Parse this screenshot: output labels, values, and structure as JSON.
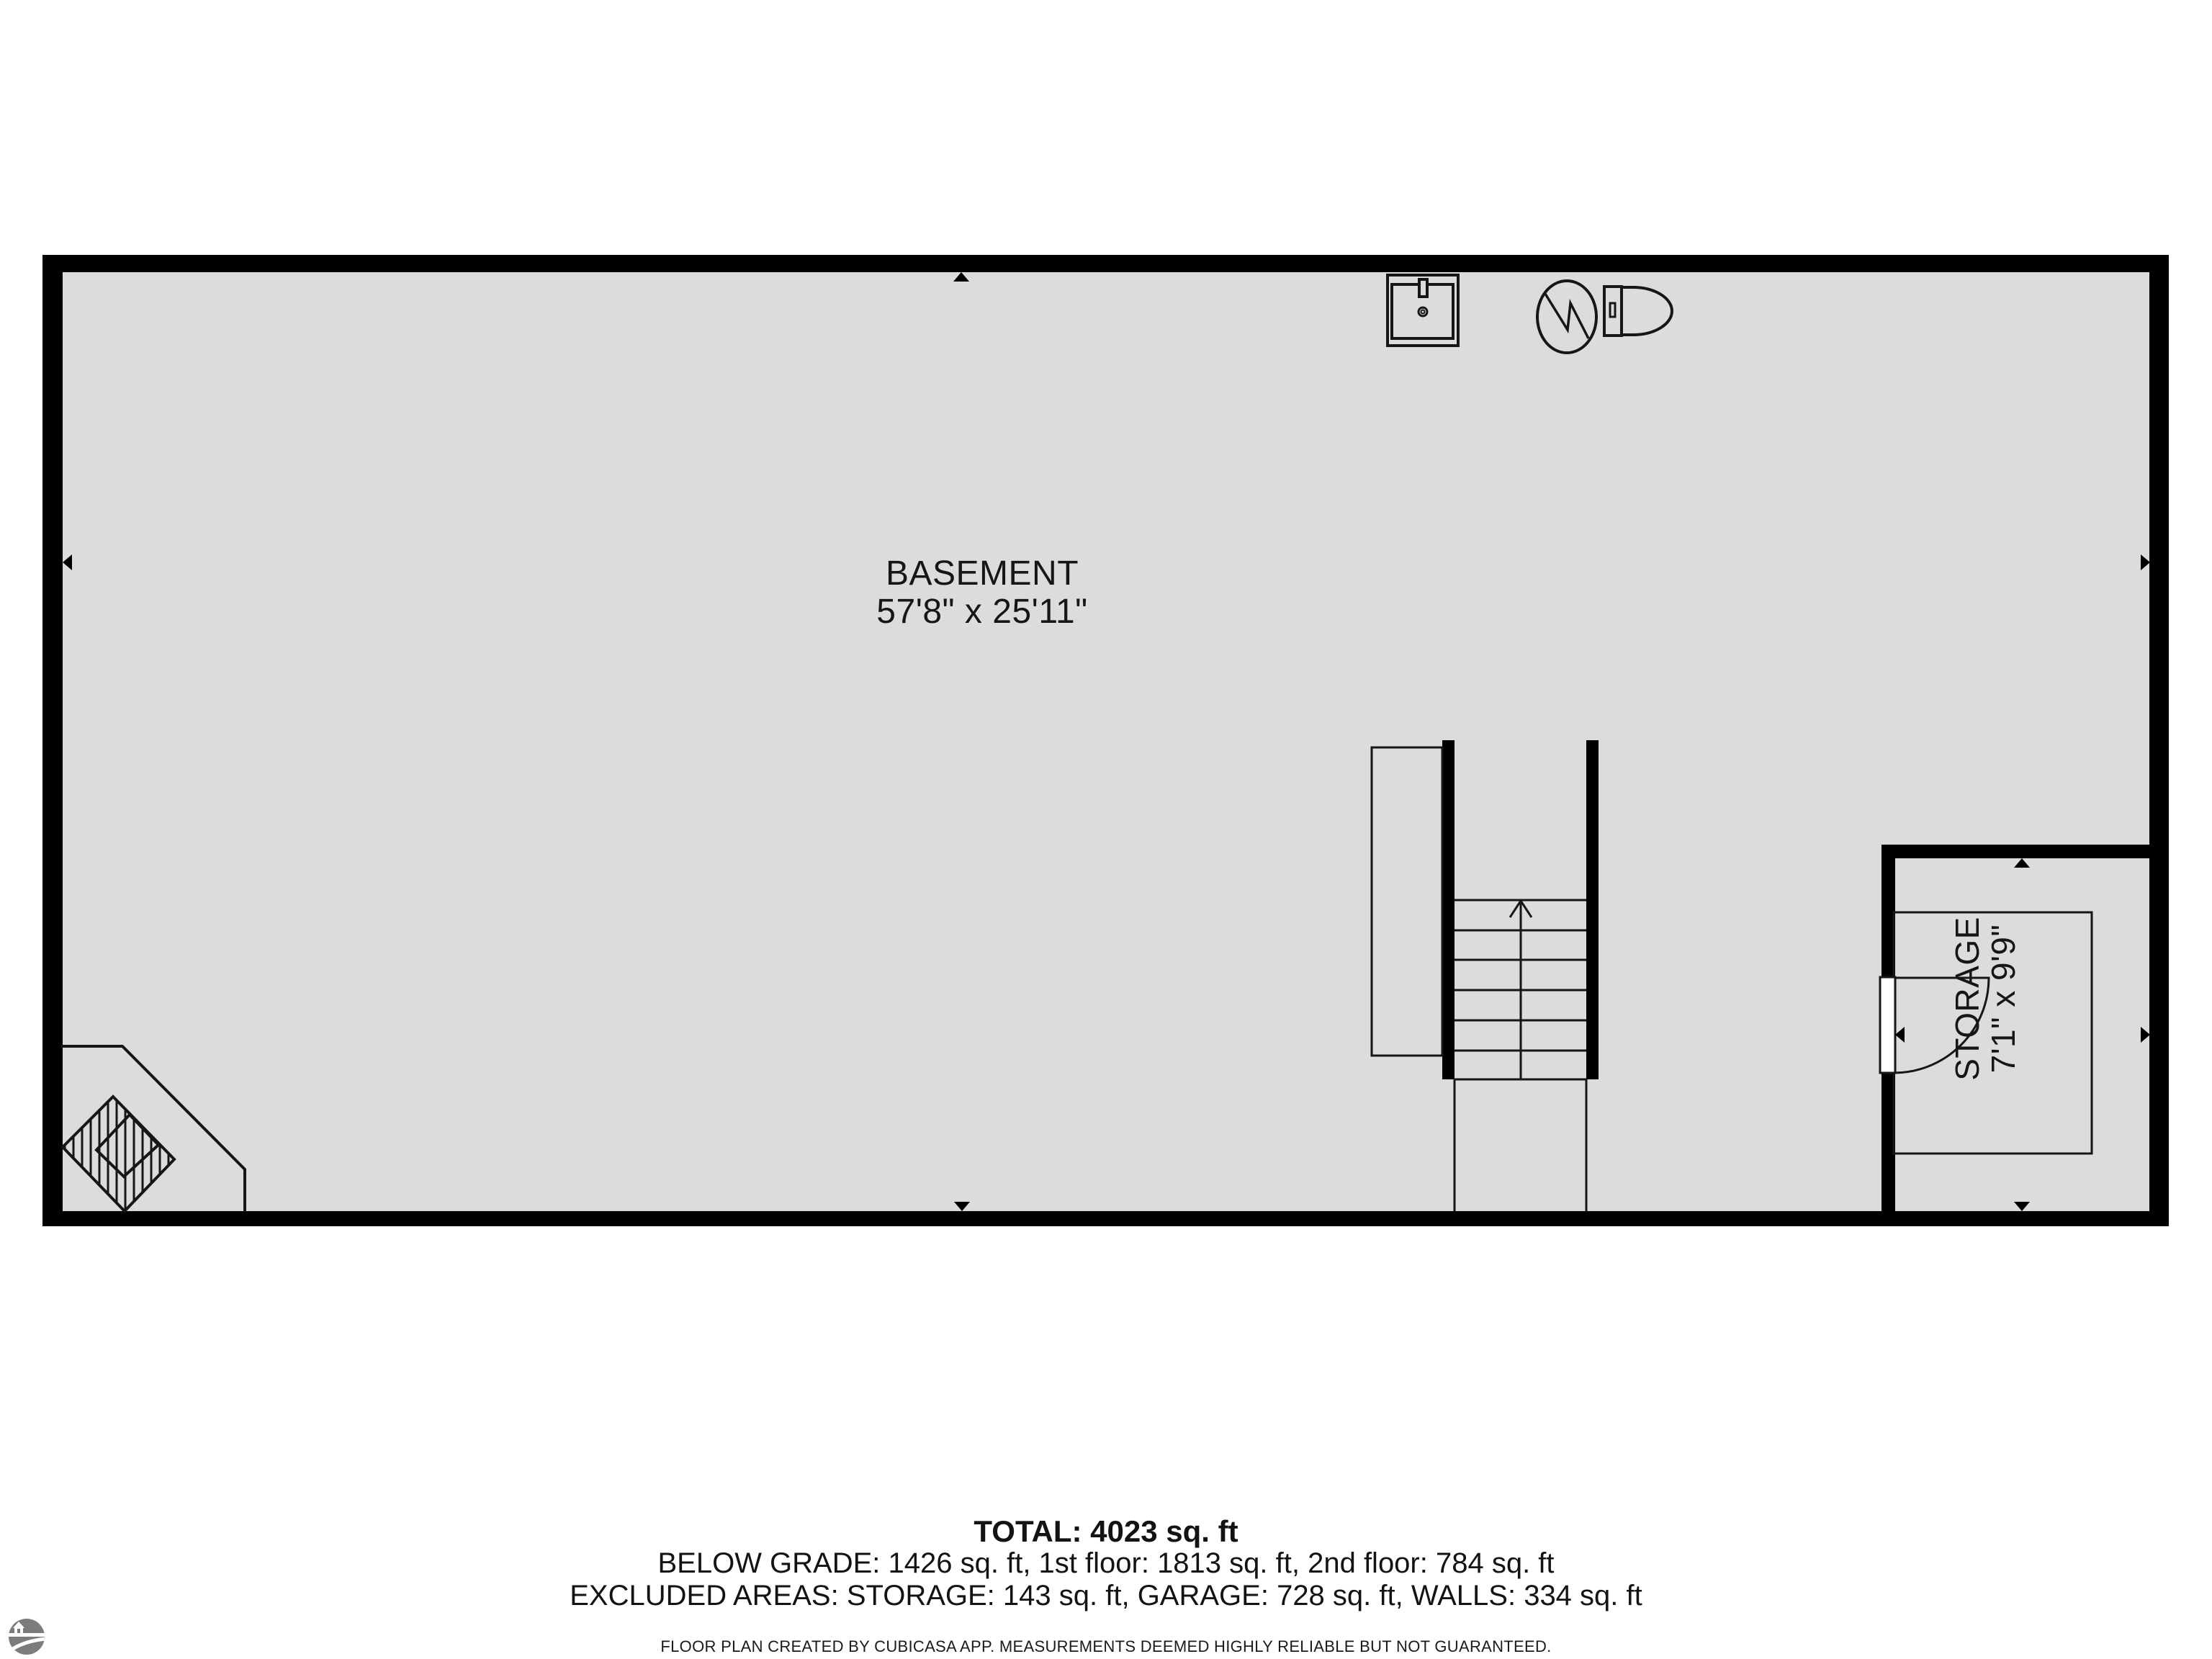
{
  "plan": {
    "rooms": [
      {
        "name": "BASEMENT",
        "dimensions": "57'8\" x 25'11\""
      },
      {
        "name": "STORAGE",
        "dimensions": "7'1\" x 9'9\""
      }
    ],
    "summary": {
      "total": "TOTAL: 4023 sq. ft",
      "floors": "BELOW GRADE: 1426 sq. ft, 1st floor: 1813 sq. ft, 2nd floor: 784 sq. ft",
      "excluded": "EXCLUDED AREAS: STORAGE: 143 sq. ft, GARAGE: 728 sq. ft, WALLS: 334 sq. ft"
    },
    "disclaimer": "FLOOR PLAN CREATED BY CUBICASA APP. MEASUREMENTS DEEMED HIGHLY RELIABLE BUT NOT GUARANTEED.",
    "icons": {
      "sink": "sink-icon",
      "water_heater": "water-heater-icon",
      "toilet": "toilet-icon",
      "stairs": "stairs-up-icon",
      "fireplace": "fireplace-icon",
      "door": "door-swing-icon",
      "wall_markers": "wall-midpoint-arrow-icon",
      "logo": "cubicasa-logo-icon"
    },
    "colors": {
      "floor": "#dcdcdc",
      "wall": "#000000",
      "line": "#161616",
      "door_leaf": "#ffffff",
      "logo_gray": "#7c7c7a",
      "background": "#ffffff"
    }
  }
}
